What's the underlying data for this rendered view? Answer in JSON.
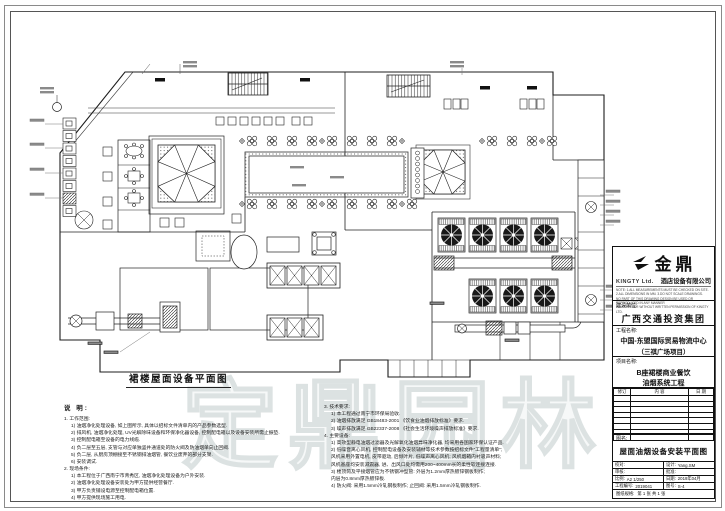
{
  "sheet": {
    "caption": "裙楼屋面设备平面图",
    "watermark": "定鼎园林"
  },
  "titleblock": {
    "logo_zh": "金鼎",
    "logo_en": "KINGTY Ltd.",
    "company": "酒店设备有限公司",
    "notice_lines": [
      "NOTE: 1.ALL MEASUREMENTS MUST BE CHECKED ON SITE.",
      "2.ALL DIMENSIONS IN MM.   3.DO NOT SCALE DRAWINGS.",
      "NO PART OF THIS DRAWING DESIGN BE USED OR REPRODUCED IN ANY MANNER",
      "WHATSOEVER WITHOUT WRITTEN PERMISSION OF KINGTY LTD."
    ],
    "client_label": "建设单位:",
    "client": "广西交通投资集团",
    "project_label": "工程名称:",
    "project_line1": "中国-东盟国际贸易物流中心",
    "project_line2": "（三祺广场项目）",
    "item_label": "项目名称:",
    "item_line1": "B座裙楼商业餐饮",
    "item_line2": "油烟系统工程",
    "revision_headers": [
      "修订",
      "内  容",
      "日  期"
    ],
    "drawing_label": "图名:",
    "drawing_title": "屋面油烟设备安装平面图",
    "fields": {
      "check_label": "校对:",
      "check_value": "",
      "design_label": "设计:",
      "design_value": "Yang.SM",
      "audit_label": "审核:",
      "audit_value": "",
      "approve_label": "批准:",
      "approve_value": "",
      "scale_label": "比例:",
      "scale_value": "A2  1/250",
      "date_label": "日期:",
      "date_value": "2019年04月",
      "job_label": "工程编号:",
      "job_value": "2019041",
      "no_label": "图号:",
      "no_value": "S-4",
      "paper_label": "图纸规格:",
      "paper_value": "第 1 张  共 1 张"
    }
  },
  "notes": {
    "title": "说 明:",
    "left": [
      "1. 工作范围:",
      "1) 油烟净化处理设备, 如上图所示, 具体以招标文件清单内的产品参数选型.",
      "2) 排风机, 油烟净化处理, UV光解除味设备和环保净化器设备, 控制配电箱以及设备安装所需止振垫.",
      "3) 控制配电箱至设备的电力线缆.",
      "4) 负二层至五层, 支管与对应单独竖井通道处的防火阀及防油烟单向止回阀.",
      "5) 负二层, 从厨房顶棚接至不锈钢排油烟管, 餐饮业废弃的部分支架.",
      "6) 安装调试.",
      "2. 现场条件:",
      "1) 本工程位于广西南宁市青秀区, 油烟净化处理设备为户外安装.",
      "2) 油烟净化处理设备安装处为甲方提供经营餐厅.",
      "3) 甲方负责铺设电源至控制配电箱位置.",
      "4) 甲方提供现场施工用电."
    ],
    "right": [
      "3. 技术要求:",
      "1) 本工程通过南宁市环保局验收.",
      "2) 油烟排放满足 GB18483-2001 《饮食业油烟排放标准》要求.",
      "3) 噪声排放满足 GB22337-2008 《社会生活环境噪声排放标准》要求.",
      "4. 主要设备:",
      "1) 高效型静电油烟过滤器及光解氧化油烟异味净化器, 均采用各国家环保认证产品.",
      "2) 低噪音离心风机, 控制配电设备及安装辅材等技术参数按招标文件“工程量清单”;",
      "风机采用外置电机, 皮带驱动, 后倾叶片, 低噪声离心风机; 风机烟箱内衬吸声材料;",
      "风机基座均安装减震器, 进、出风口处均需用200~400mm长的柔性软连接连接.",
      "3) 楼顶筒及平接烟管应为不锈钢冲型管: 外层为1.2mm厚热镀锌钢板制作;",
      "内层为0.8mm厚热镀锌板.",
      "4) 防火阀: 采用1.5mm冷轧钢板制作; 止回阀: 采用1.5mm冷轧钢板制作."
    ]
  }
}
